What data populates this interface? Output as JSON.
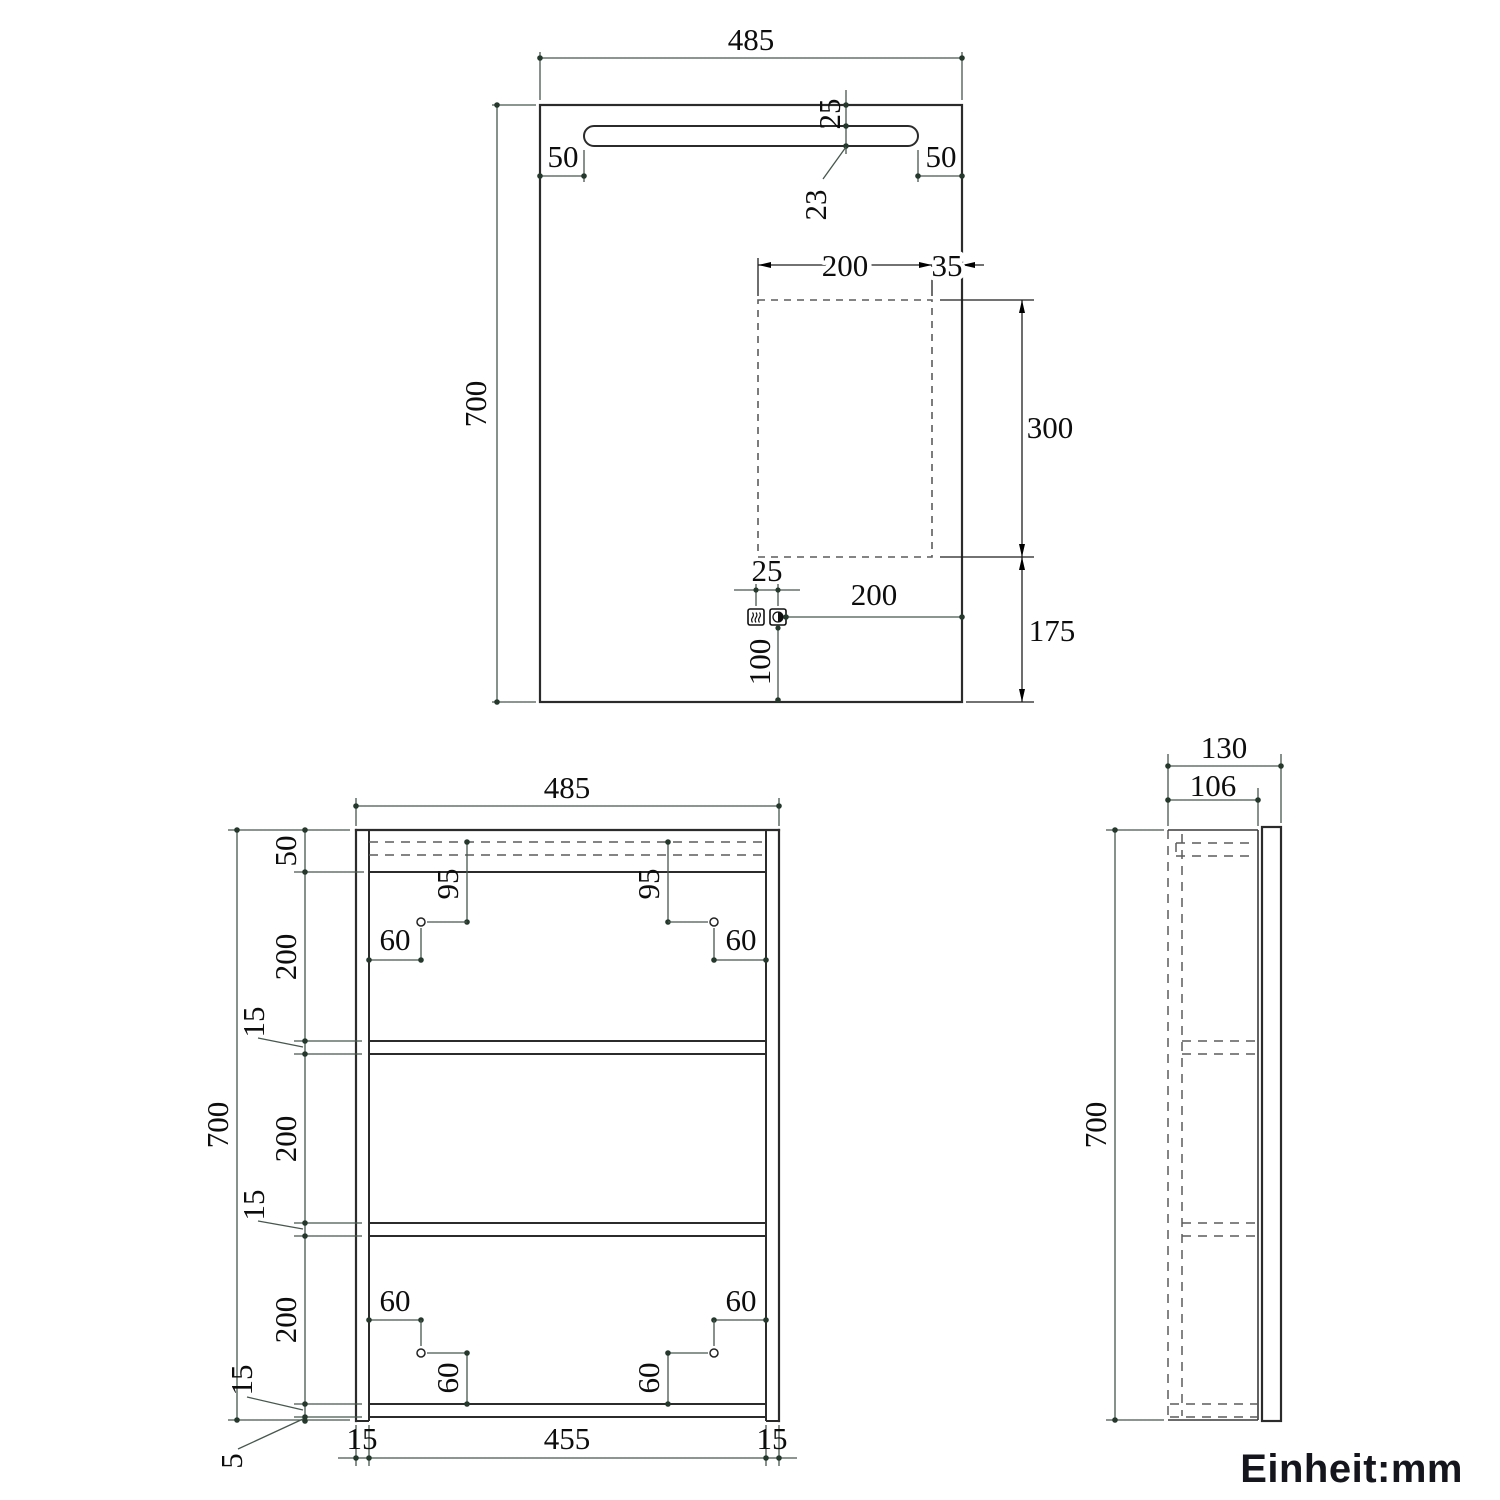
{
  "unit_label": "Einheit:mm",
  "colors": {
    "dimension_line_green": "#46584e",
    "dimension_line_black": "#1f1f1f",
    "drawing_line": "#2b2b2b",
    "hidden_line_gray": "#5b5b5b",
    "text_ink": "#0d0d0d",
    "background": "#ffffff"
  },
  "mirror": {
    "width": "485",
    "height": "700",
    "slot_left": "50",
    "slot_right": "50",
    "slot_top": "25",
    "slot_thickness": "23",
    "pad_width": "200",
    "pad_right": "35",
    "pad_height": "300",
    "pad_bottom": "175",
    "btn_gap": "25",
    "btn_right": "200",
    "btn_bottom": "100"
  },
  "cabinet": {
    "width": "485",
    "height": "700",
    "top_section": "50",
    "gap_a": "200",
    "shelf_a": "15",
    "gap_b": "200",
    "shelf_b": "15",
    "gap_c": "200",
    "shelf_c": "15",
    "bottom_gap": "5",
    "hinge_down_left": "95",
    "hinge_down_right": "95",
    "hinge_in_top_left": "60",
    "hinge_in_top_right": "60",
    "hinge_in_bot_left": "60",
    "hinge_in_bot_right": "60",
    "hinge_up_left": "60",
    "hinge_up_right": "60",
    "base_left": "15",
    "base_width": "455",
    "base_right": "15"
  },
  "side": {
    "depth": "130",
    "body_depth": "106",
    "height": "700"
  }
}
